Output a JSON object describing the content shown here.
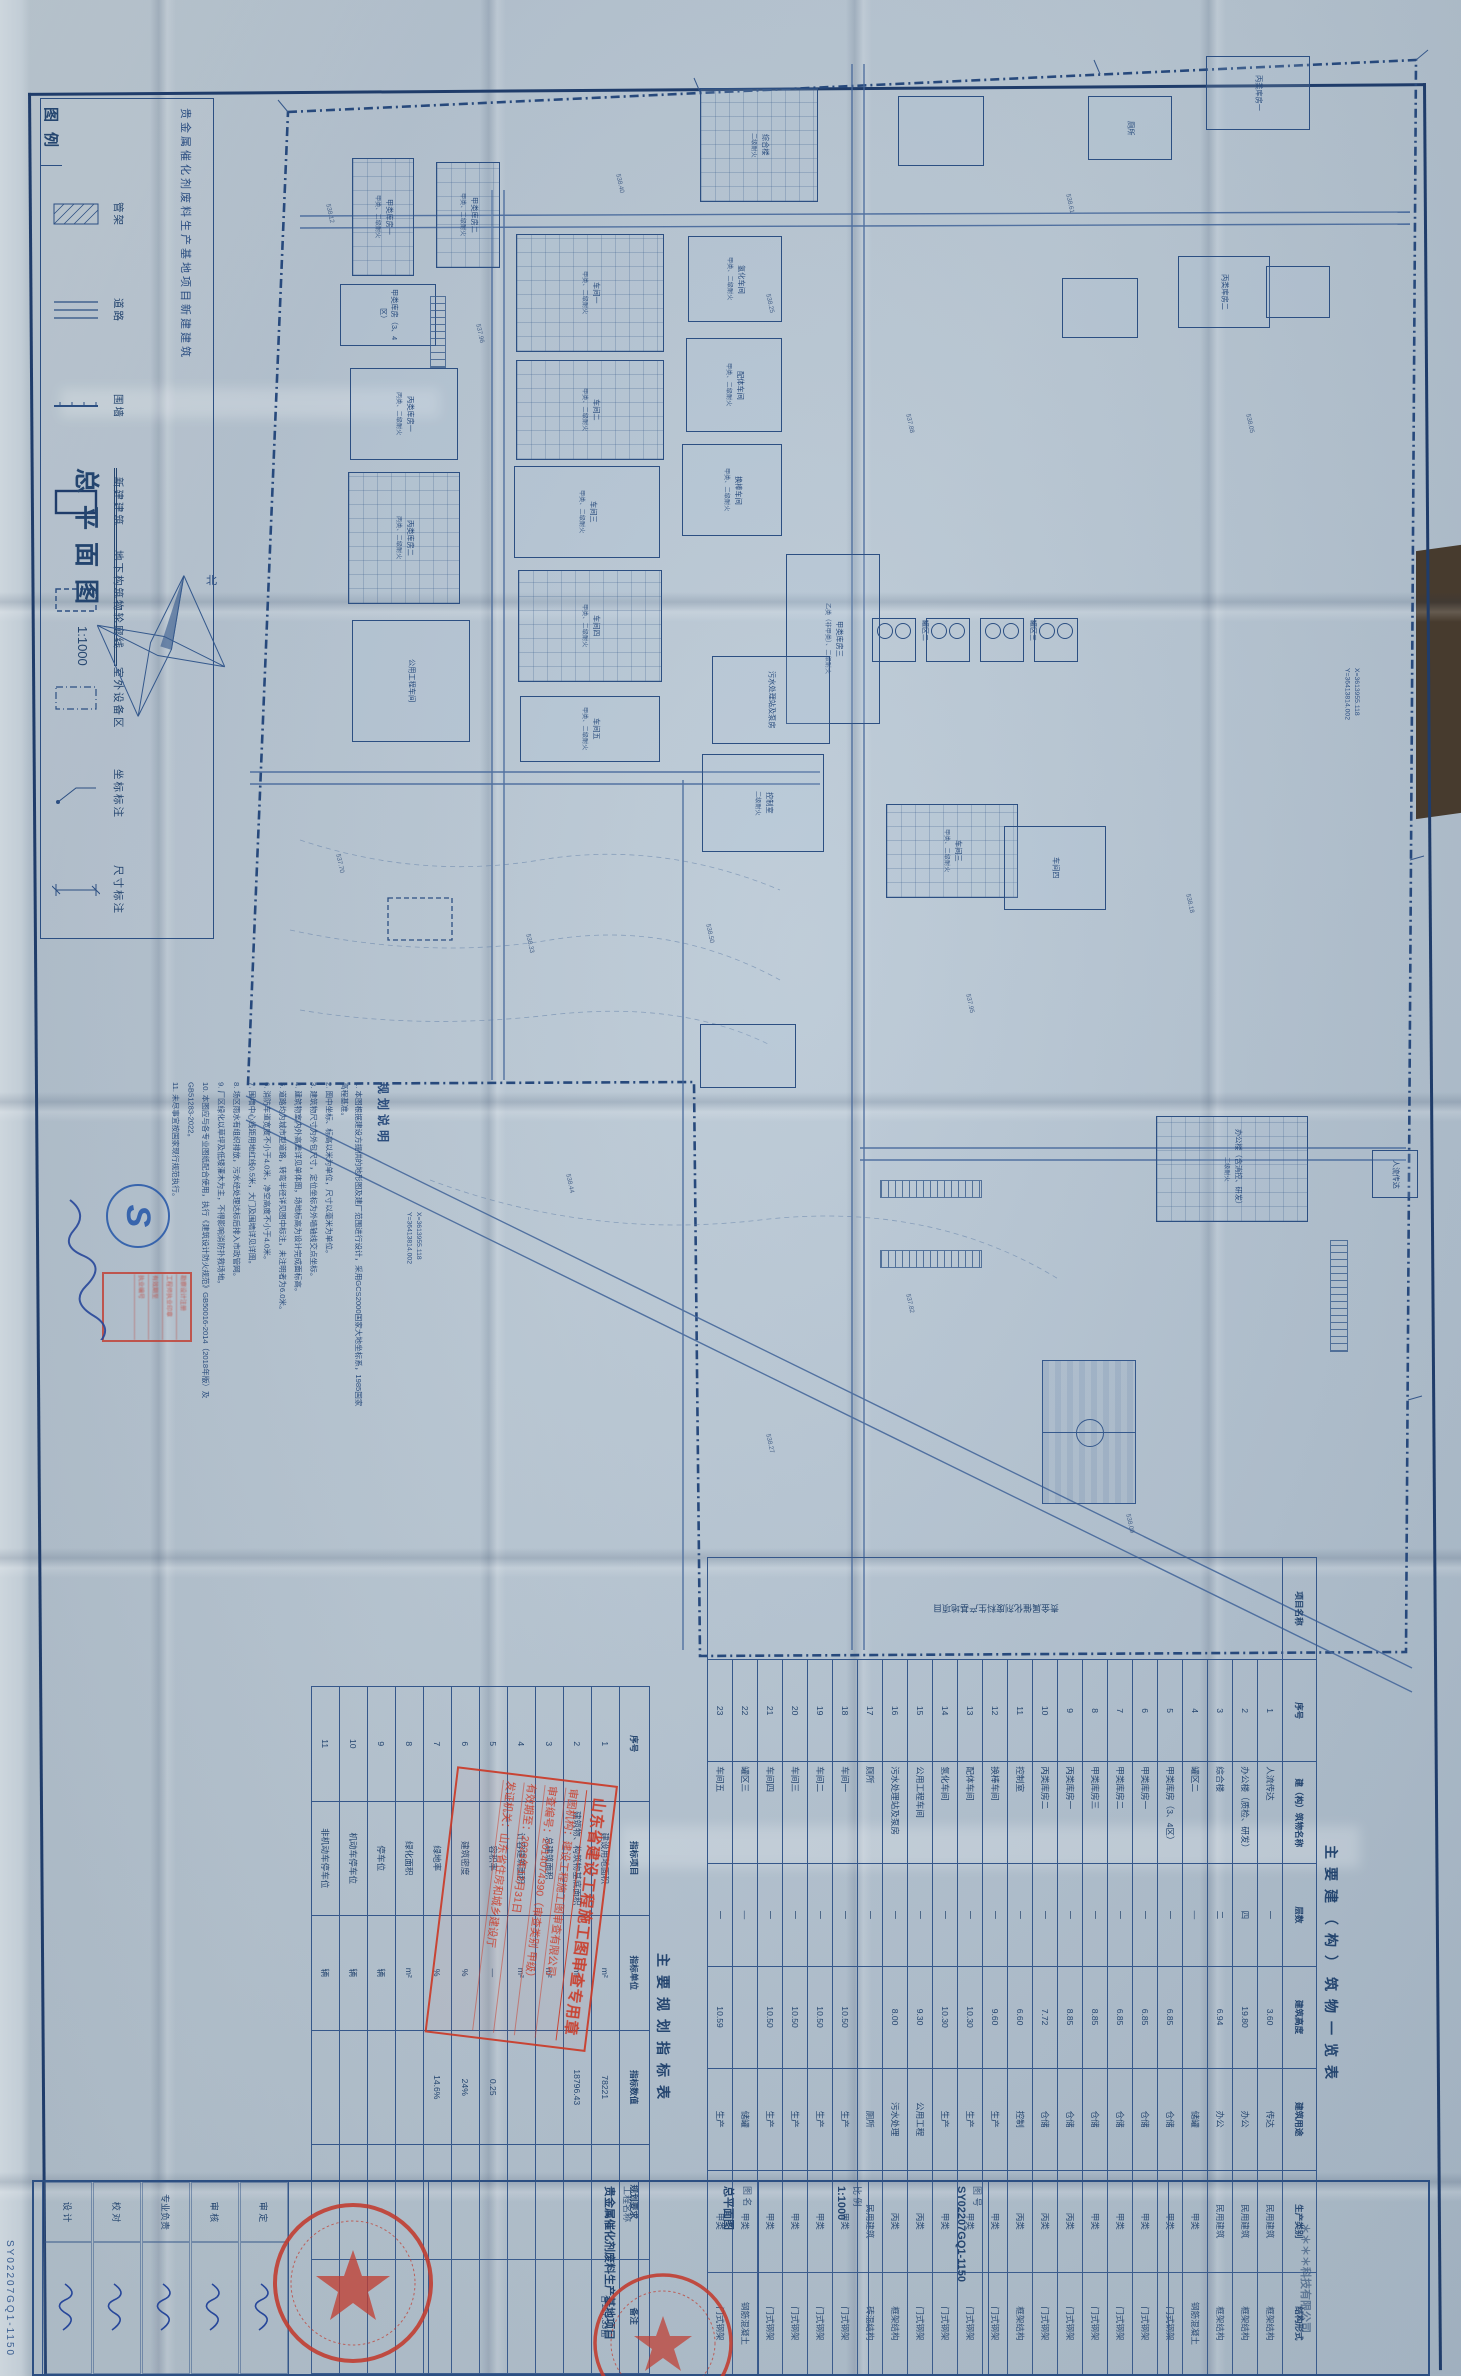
{
  "sheet": {
    "title": "总平面图",
    "scale": "1:1000",
    "drawing_no": "SY02207GQ1-1150"
  },
  "legend": {
    "title": "图例",
    "project_line": "贵金属催化剂废料生产基地项目新建建筑",
    "items": [
      {
        "name": "管架",
        "type": "hatch"
      },
      {
        "name": "道路",
        "type": "road"
      },
      {
        "name": "围墙",
        "type": "wall"
      },
      {
        "name": "新建建筑",
        "type": "bldg"
      },
      {
        "name": "地下构筑物轮廓线",
        "type": "dash"
      },
      {
        "name": "室外设备区",
        "type": "dashdot"
      },
      {
        "name": "坐标标注",
        "type": "coord"
      },
      {
        "name": "尺寸标注",
        "type": "dim"
      }
    ]
  },
  "notes": {
    "title": "规划说明",
    "lines": [
      "1. 本图根据建设方提供的地形图及建厂范围进行设计，采用GCS2000国家大地坐标系，1985国家高程基准。",
      "2. 图中坐标、标高以米为单位，尺寸以毫米为单位。",
      "3. 建筑物尺寸为外包尺寸，定位坐标为外墙轴线交点坐标。",
      "4. 建筑物室内外高差详见单体图，场地标高为设计完成面标高。",
      "5. 道路均为城市型道路，转弯半径详见图中标注，未注明者为6.0米。",
      "6. 消防车道宽度不小于4.0米，净空高度不小于4.0米。",
      "7. 围墙中心线距用地红线0.5米，大门及围墙详见详图。",
      "8. 场区雨水有组织排放，污水经处理达标后排入市政管网。",
      "9. 厂区绿化以草坪及低矮灌木为主，不得影响消防扑救场地。",
      "10. 本图应与各专业图纸配合使用，执行《建筑设计防火规范》GB50016-2014（2018年版）及GB51283-2022。",
      "11. 未尽事宜按国家现行规范执行。"
    ]
  },
  "indicator_table": {
    "title": "主要规划指标表",
    "headers": [
      "序号",
      "指标项目",
      "指标单位",
      "指标数值",
      "规划要求",
      "备注"
    ],
    "rows": [
      {
        "no": "1",
        "item": "建设用地面积",
        "unit": "m²",
        "value": "78221",
        "req": "",
        "remark": "合117.33亩"
      },
      {
        "no": "2",
        "item": "建筑物、构筑物基底面积",
        "unit": "m²",
        "value": "18796.43",
        "req": "",
        "remark": ""
      },
      {
        "no": "3",
        "item": "总建筑面积",
        "unit": "m²",
        "value": "",
        "req": "",
        "remark": ""
      },
      {
        "no": "4",
        "item": "计容建筑面积",
        "unit": "m²",
        "value": "",
        "req": "",
        "remark": ""
      },
      {
        "no": "5",
        "item": "容积率",
        "unit": "—",
        "value": "0.25",
        "req": "",
        "remark": ""
      },
      {
        "no": "6",
        "item": "建筑密度",
        "unit": "%",
        "value": "24%",
        "req": "",
        "remark": ""
      },
      {
        "no": "7",
        "item": "绿地率",
        "unit": "%",
        "value": "14.6%",
        "req": "",
        "remark": ""
      },
      {
        "no": "8",
        "item": "绿化面积",
        "unit": "m²",
        "value": "",
        "req": "",
        "remark": ""
      },
      {
        "no": "9",
        "item": "停车位",
        "unit": "辆",
        "value": "",
        "req": "",
        "remark": ""
      },
      {
        "no": "10",
        "item": "机动车停车位",
        "unit": "辆",
        "value": "",
        "req": "",
        "remark": ""
      },
      {
        "no": "11",
        "item": "非机动车停车位",
        "unit": "辆",
        "value": "",
        "req": "",
        "remark": ""
      }
    ]
  },
  "building_table": {
    "title": "主要建（构）筑物一览表",
    "project_label": "项目名称",
    "project_name": "贵金属催化剂废料生产基地项目",
    "headers": [
      "序号",
      "建（构）筑物名称",
      "层数",
      "建筑高度",
      "建筑用途",
      "生产类别",
      "结构形式"
    ],
    "rows": [
      {
        "no": "1",
        "name": "人流传达",
        "floors": "一",
        "height": "3.60",
        "use": "传达",
        "cat": "民用建筑",
        "struct": "框架结构"
      },
      {
        "no": "2",
        "name": "办公楼（质检、研发）",
        "floors": "四",
        "height": "19.80",
        "use": "办公",
        "cat": "民用建筑",
        "struct": "框架结构"
      },
      {
        "no": "3",
        "name": "综合楼",
        "floors": "二",
        "height": "6.94",
        "use": "办公",
        "cat": "民用建筑",
        "struct": "框架结构"
      },
      {
        "no": "4",
        "name": "罐区二",
        "floors": "—",
        "height": "",
        "use": "储罐",
        "cat": "甲类",
        "struct": "钢筋混凝土"
      },
      {
        "no": "5",
        "name": "甲类库房（3、4区）",
        "floors": "一",
        "height": "6.85",
        "use": "仓储",
        "cat": "甲类",
        "struct": "门式钢架"
      },
      {
        "no": "6",
        "name": "甲类库房一",
        "floors": "一",
        "height": "6.85",
        "use": "仓储",
        "cat": "甲类",
        "struct": "门式钢架"
      },
      {
        "no": "7",
        "name": "甲类库房二",
        "floors": "一",
        "height": "6.85",
        "use": "仓储",
        "cat": "甲类",
        "struct": "门式钢架"
      },
      {
        "no": "8",
        "name": "甲类库房三",
        "floors": "一",
        "height": "8.85",
        "use": "仓储",
        "cat": "甲类",
        "struct": "门式钢架"
      },
      {
        "no": "9",
        "name": "丙类库房一",
        "floors": "一",
        "height": "8.85",
        "use": "仓储",
        "cat": "丙类",
        "struct": "门式钢架"
      },
      {
        "no": "10",
        "name": "丙类库房二",
        "floors": "一",
        "height": "7.72",
        "use": "仓储",
        "cat": "丙类",
        "struct": "门式钢架"
      },
      {
        "no": "11",
        "name": "控制室",
        "floors": "一",
        "height": "6.60",
        "use": "控制",
        "cat": "丙类",
        "struct": "框架结构"
      },
      {
        "no": "12",
        "name": "换棒车间",
        "floors": "一",
        "height": "9.60",
        "use": "生产",
        "cat": "甲类",
        "struct": "门式钢架"
      },
      {
        "no": "13",
        "name": "配体车间",
        "floors": "一",
        "height": "10.30",
        "use": "生产",
        "cat": "甲类",
        "struct": "门式钢架"
      },
      {
        "no": "14",
        "name": "氢化车间",
        "floors": "一",
        "height": "10.30",
        "use": "生产",
        "cat": "甲类",
        "struct": "门式钢架"
      },
      {
        "no": "15",
        "name": "公用工程车间",
        "floors": "一",
        "height": "9.30",
        "use": "公用工程",
        "cat": "丙类",
        "struct": "门式钢架"
      },
      {
        "no": "16",
        "name": "污水处理站及泵房",
        "floors": "一",
        "height": "8.00",
        "use": "污水处理",
        "cat": "丙类",
        "struct": "框架结构"
      },
      {
        "no": "17",
        "name": "厕所",
        "floors": "一",
        "height": "",
        "use": "厕所",
        "cat": "民用建筑",
        "struct": "砖混结构"
      },
      {
        "no": "18",
        "name": "车间一",
        "floors": "一",
        "height": "10.50",
        "use": "生产",
        "cat": "甲类",
        "struct": "门式钢架"
      },
      {
        "no": "19",
        "name": "车间二",
        "floors": "一",
        "height": "10.50",
        "use": "生产",
        "cat": "甲类",
        "struct": "门式钢架"
      },
      {
        "no": "20",
        "name": "车间三",
        "floors": "一",
        "height": "10.50",
        "use": "生产",
        "cat": "甲类",
        "struct": "门式钢架"
      },
      {
        "no": "21",
        "name": "车间四",
        "floors": "一",
        "height": "10.50",
        "use": "生产",
        "cat": "甲类",
        "struct": "门式钢架"
      },
      {
        "no": "22",
        "name": "罐区三",
        "floors": "—",
        "height": "",
        "use": "储罐",
        "cat": "甲类",
        "struct": "钢筋混凝土"
      },
      {
        "no": "23",
        "name": "车间五",
        "floors": "一",
        "height": "10.59",
        "use": "生产",
        "cat": "甲类",
        "struct": "门式钢架"
      }
    ]
  },
  "stamp_review": {
    "title": "山东省建设工程施工图审查专用章",
    "lines": [
      "审图机构：建设工程施工图审查有限公司",
      "审查编号：2014074390（审查类别 甲级）",
      "有效期至：2023年12月31日",
      "发证机关：山东省住房和城乡建设厅"
    ]
  },
  "seals": {
    "company_seal_note": "（公司印章·文字模糊）",
    "reg_stamp_lines": [
      "勘察设计注册",
      "工程师执业印章",
      "有效期至",
      "执业编号"
    ],
    "s_logo": "S"
  },
  "titleblock": {
    "company": "＊＊＊＊科技有限公司",
    "project_label": "工程名称",
    "project_name": "贵金属催化剂废料生产基地项目",
    "dwgname_label": "图  名",
    "dwgname": "总平面图",
    "dwgno_label": "图  号",
    "dwgno": "SY02207GQ1-1150",
    "scale_label": "比  例",
    "scale": "1:1000",
    "sign_rows": [
      "审 定",
      "审 核",
      "专业负责",
      "校 对",
      "设 计"
    ]
  },
  "plan": {
    "north_label": "北",
    "coord_callouts": [
      {
        "x": 404,
        "y": 1212,
        "t1": "X=3613955.118",
        "t2": "Y=36413814.002"
      },
      {
        "x": 1342,
        "y": 668,
        "t1": "X=3613955.118",
        "t2": "Y=36413814.002"
      }
    ],
    "tank_groups": [
      {
        "x": 872,
        "y": 618,
        "label": "罐区二"
      },
      {
        "x": 926,
        "y": 618,
        "label": ""
      },
      {
        "x": 980,
        "y": 618,
        "label": "罐区三"
      },
      {
        "x": 1034,
        "y": 618,
        "label": ""
      }
    ],
    "buildings": [
      {
        "x": 352,
        "y": 158,
        "w": 62,
        "h": 118,
        "label": "甲类库房一",
        "sub": "甲类、二级耐火",
        "grid": true
      },
      {
        "x": 436,
        "y": 162,
        "w": 64,
        "h": 106,
        "label": "甲类库房二",
        "sub": "甲类、二级耐火",
        "grid": true
      },
      {
        "x": 340,
        "y": 284,
        "w": 96,
        "h": 62,
        "label": "甲类库房（3、4区）",
        "sub": ""
      },
      {
        "x": 350,
        "y": 368,
        "w": 108,
        "h": 92,
        "label": "丙类库房一",
        "sub": "丙类、二级耐火"
      },
      {
        "x": 348,
        "y": 472,
        "w": 112,
        "h": 132,
        "label": "丙类库房二",
        "sub": "丙类、二级耐火",
        "grid": true
      },
      {
        "x": 352,
        "y": 620,
        "w": 118,
        "h": 122,
        "label": "公用工程车间",
        "sub": ""
      },
      {
        "x": 516,
        "y": 234,
        "w": 148,
        "h": 118,
        "label": "车间一",
        "sub": "甲类、二级耐火",
        "grid": true
      },
      {
        "x": 516,
        "y": 360,
        "w": 148,
        "h": 100,
        "label": "车间二",
        "sub": "甲类、二级耐火",
        "grid": true
      },
      {
        "x": 514,
        "y": 466,
        "w": 146,
        "h": 92,
        "label": "车间三",
        "sub": "甲类、二级耐火"
      },
      {
        "x": 518,
        "y": 570,
        "w": 144,
        "h": 112,
        "label": "车间四",
        "sub": "甲类、二级耐火",
        "grid": true
      },
      {
        "x": 520,
        "y": 696,
        "w": 140,
        "h": 66,
        "label": "车间五",
        "sub": "甲类、二级耐火"
      },
      {
        "x": 700,
        "y": 88,
        "w": 118,
        "h": 114,
        "label": "综合楼",
        "sub": "二级耐火",
        "grid": true
      },
      {
        "x": 688,
        "y": 236,
        "w": 94,
        "h": 86,
        "label": "氢化车间",
        "sub": "甲类、二级耐火"
      },
      {
        "x": 686,
        "y": 338,
        "w": 96,
        "h": 94,
        "label": "配体车间",
        "sub": "甲类、二级耐火"
      },
      {
        "x": 682,
        "y": 444,
        "w": 100,
        "h": 92,
        "label": "换棒车间",
        "sub": "甲类、二级耐火"
      },
      {
        "x": 786,
        "y": 554,
        "w": 94,
        "h": 170,
        "label": "甲类库房三",
        "sub": "乙类（非甲类）、二级耐火"
      },
      {
        "x": 712,
        "y": 656,
        "w": 118,
        "h": 88,
        "label": "污水处理站及泵房",
        "sub": ""
      },
      {
        "x": 702,
        "y": 754,
        "w": 122,
        "h": 98,
        "label": "控制室",
        "sub": "二级耐火"
      },
      {
        "x": 886,
        "y": 804,
        "w": 132,
        "h": 94,
        "label": "车间三",
        "sub": "甲类、二级耐火",
        "grid": true
      },
      {
        "x": 1004,
        "y": 826,
        "w": 102,
        "h": 84,
        "label": "车间四",
        "sub": ""
      },
      {
        "x": 898,
        "y": 96,
        "w": 86,
        "h": 70,
        "label": "",
        "sub": ""
      },
      {
        "x": 1088,
        "y": 96,
        "w": 84,
        "h": 64,
        "label": "厕所",
        "sub": ""
      },
      {
        "x": 1206,
        "y": 56,
        "w": 104,
        "h": 74,
        "label": "丙类库房一",
        "sub": ""
      },
      {
        "x": 1178,
        "y": 256,
        "w": 92,
        "h": 72,
        "label": "丙类库房二",
        "sub": ""
      },
      {
        "x": 1266,
        "y": 266,
        "w": 64,
        "h": 52,
        "label": "",
        "sub": ""
      },
      {
        "x": 1062,
        "y": 278,
        "w": 76,
        "h": 60,
        "label": "",
        "sub": ""
      },
      {
        "x": 700,
        "y": 1024,
        "w": 96,
        "h": 64,
        "label": "",
        "sub": ""
      },
      {
        "x": 1156,
        "y": 1116,
        "w": 152,
        "h": 106,
        "label": "办公楼（含消控、研发）",
        "sub": "二级耐火",
        "grid": true
      },
      {
        "x": 1372,
        "y": 1150,
        "w": 46,
        "h": 48,
        "label": "人流传达",
        "sub": ""
      }
    ],
    "spot_elevations": [
      {
        "x": 320,
        "y": 210,
        "v": "538.12"
      },
      {
        "x": 470,
        "y": 330,
        "v": "537.96"
      },
      {
        "x": 610,
        "y": 180,
        "v": "538.40"
      },
      {
        "x": 760,
        "y": 300,
        "v": "538.25"
      },
      {
        "x": 900,
        "y": 420,
        "v": "537.88"
      },
      {
        "x": 1060,
        "y": 200,
        "v": "538.61"
      },
      {
        "x": 1240,
        "y": 420,
        "v": "538.05"
      },
      {
        "x": 330,
        "y": 860,
        "v": "537.70"
      },
      {
        "x": 520,
        "y": 940,
        "v": "538.33"
      },
      {
        "x": 700,
        "y": 930,
        "v": "538.50"
      },
      {
        "x": 960,
        "y": 1000,
        "v": "537.95"
      },
      {
        "x": 1180,
        "y": 900,
        "v": "538.18"
      },
      {
        "x": 560,
        "y": 1180,
        "v": "538.44"
      },
      {
        "x": 900,
        "y": 1300,
        "v": "537.82"
      },
      {
        "x": 1120,
        "y": 1520,
        "v": "538.09"
      },
      {
        "x": 760,
        "y": 1440,
        "v": "538.27"
      }
    ]
  }
}
